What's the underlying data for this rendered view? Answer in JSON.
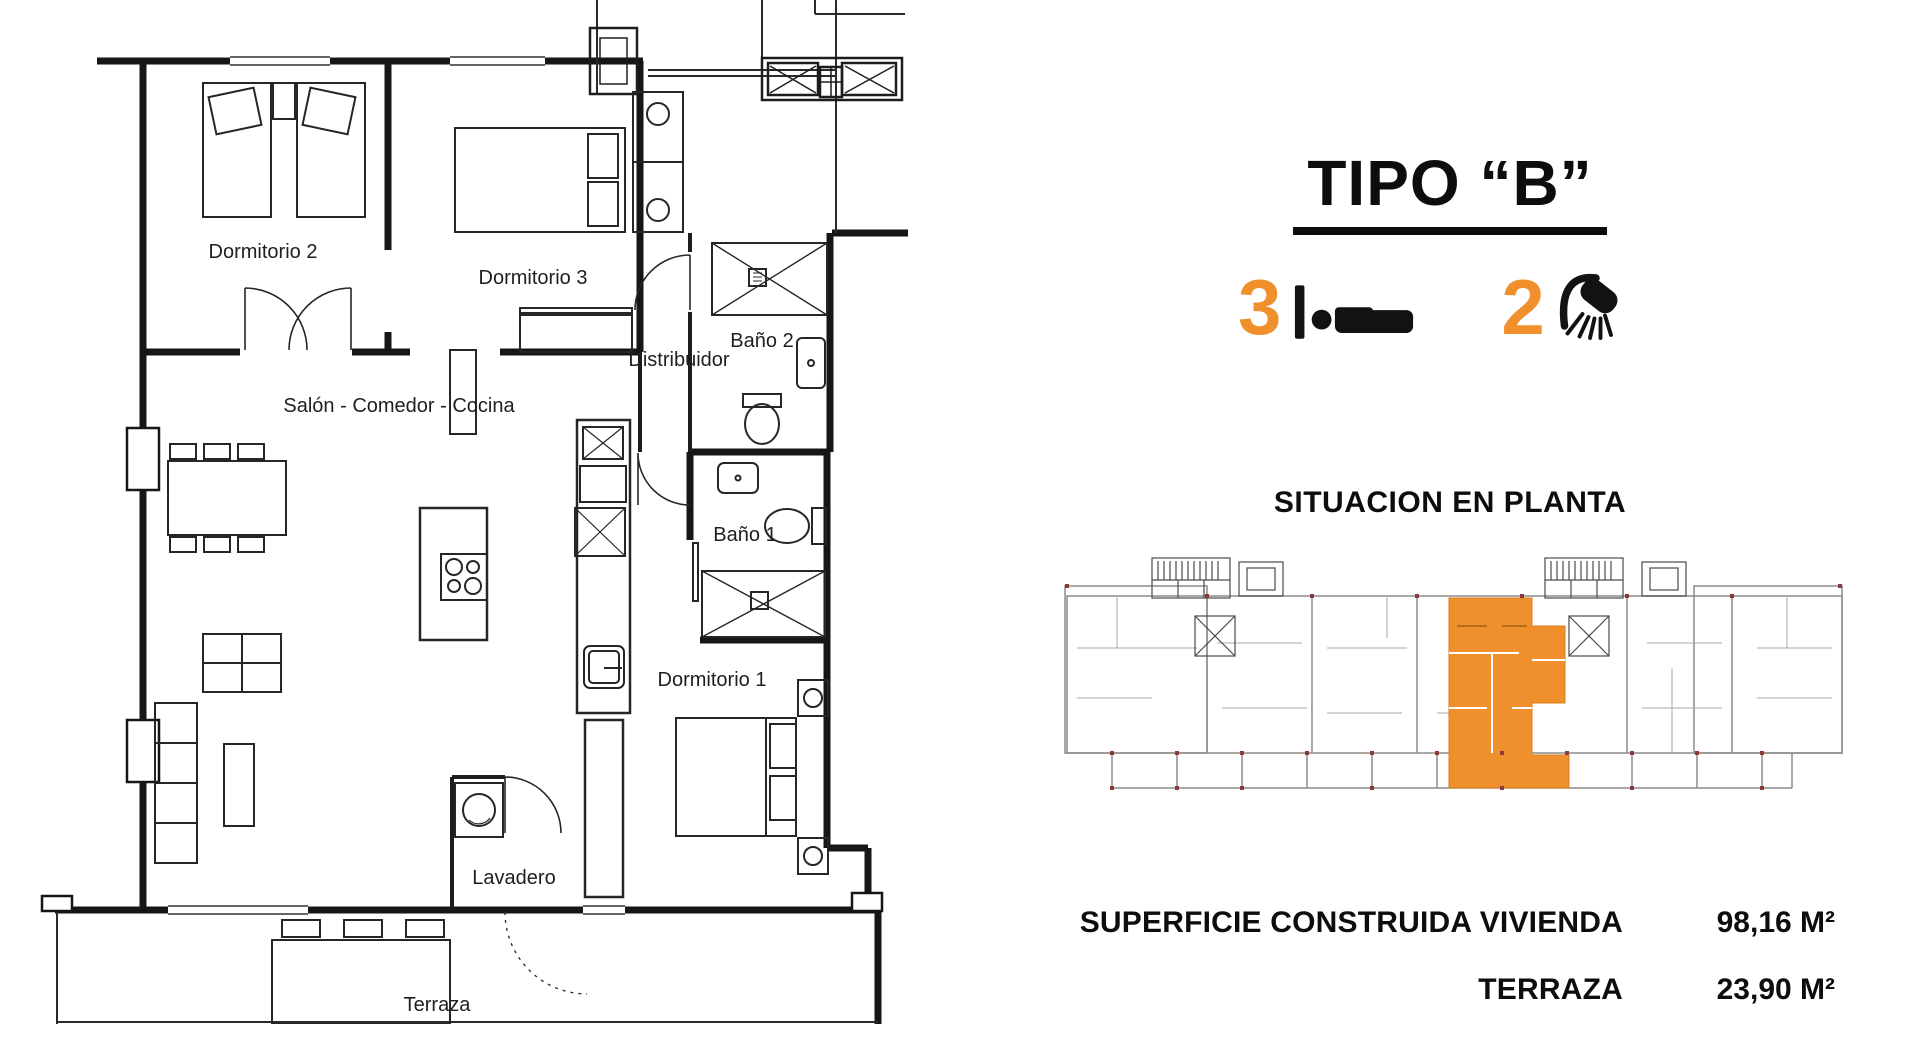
{
  "floor_plan": {
    "rooms": [
      {
        "id": "dormitorio-2",
        "label": "Dormitorio 2"
      },
      {
        "id": "dormitorio-3",
        "label": "Dormitorio 3"
      },
      {
        "id": "bano-2",
        "label": "Baño 2"
      },
      {
        "id": "distribuidor",
        "label": "Distribuidor"
      },
      {
        "id": "salon-comedor-cocina",
        "label": "Salón - Comedor - Cocina"
      },
      {
        "id": "bano-1",
        "label": "Baño 1"
      },
      {
        "id": "dormitorio-1",
        "label": "Dormitorio 1"
      },
      {
        "id": "lavadero",
        "label": "Lavadero"
      },
      {
        "id": "terraza",
        "label": "Terraza"
      }
    ]
  },
  "info_panel": {
    "title": "TIPO “B”",
    "bedrooms_count": "3",
    "bathrooms_count": "2",
    "bedrooms_icon": "bed-icon",
    "bathrooms_icon": "shower-icon",
    "situation_heading": "SITUACION EN PLANTA",
    "areas": [
      {
        "label": "SUPERFICIE CONSTRUIDA VIVIENDA",
        "value": "98,16 M²"
      },
      {
        "label": "TERRAZA",
        "value": "23,90 M²"
      }
    ],
    "accent_color": "#F0902C",
    "line_color": "#111111"
  }
}
